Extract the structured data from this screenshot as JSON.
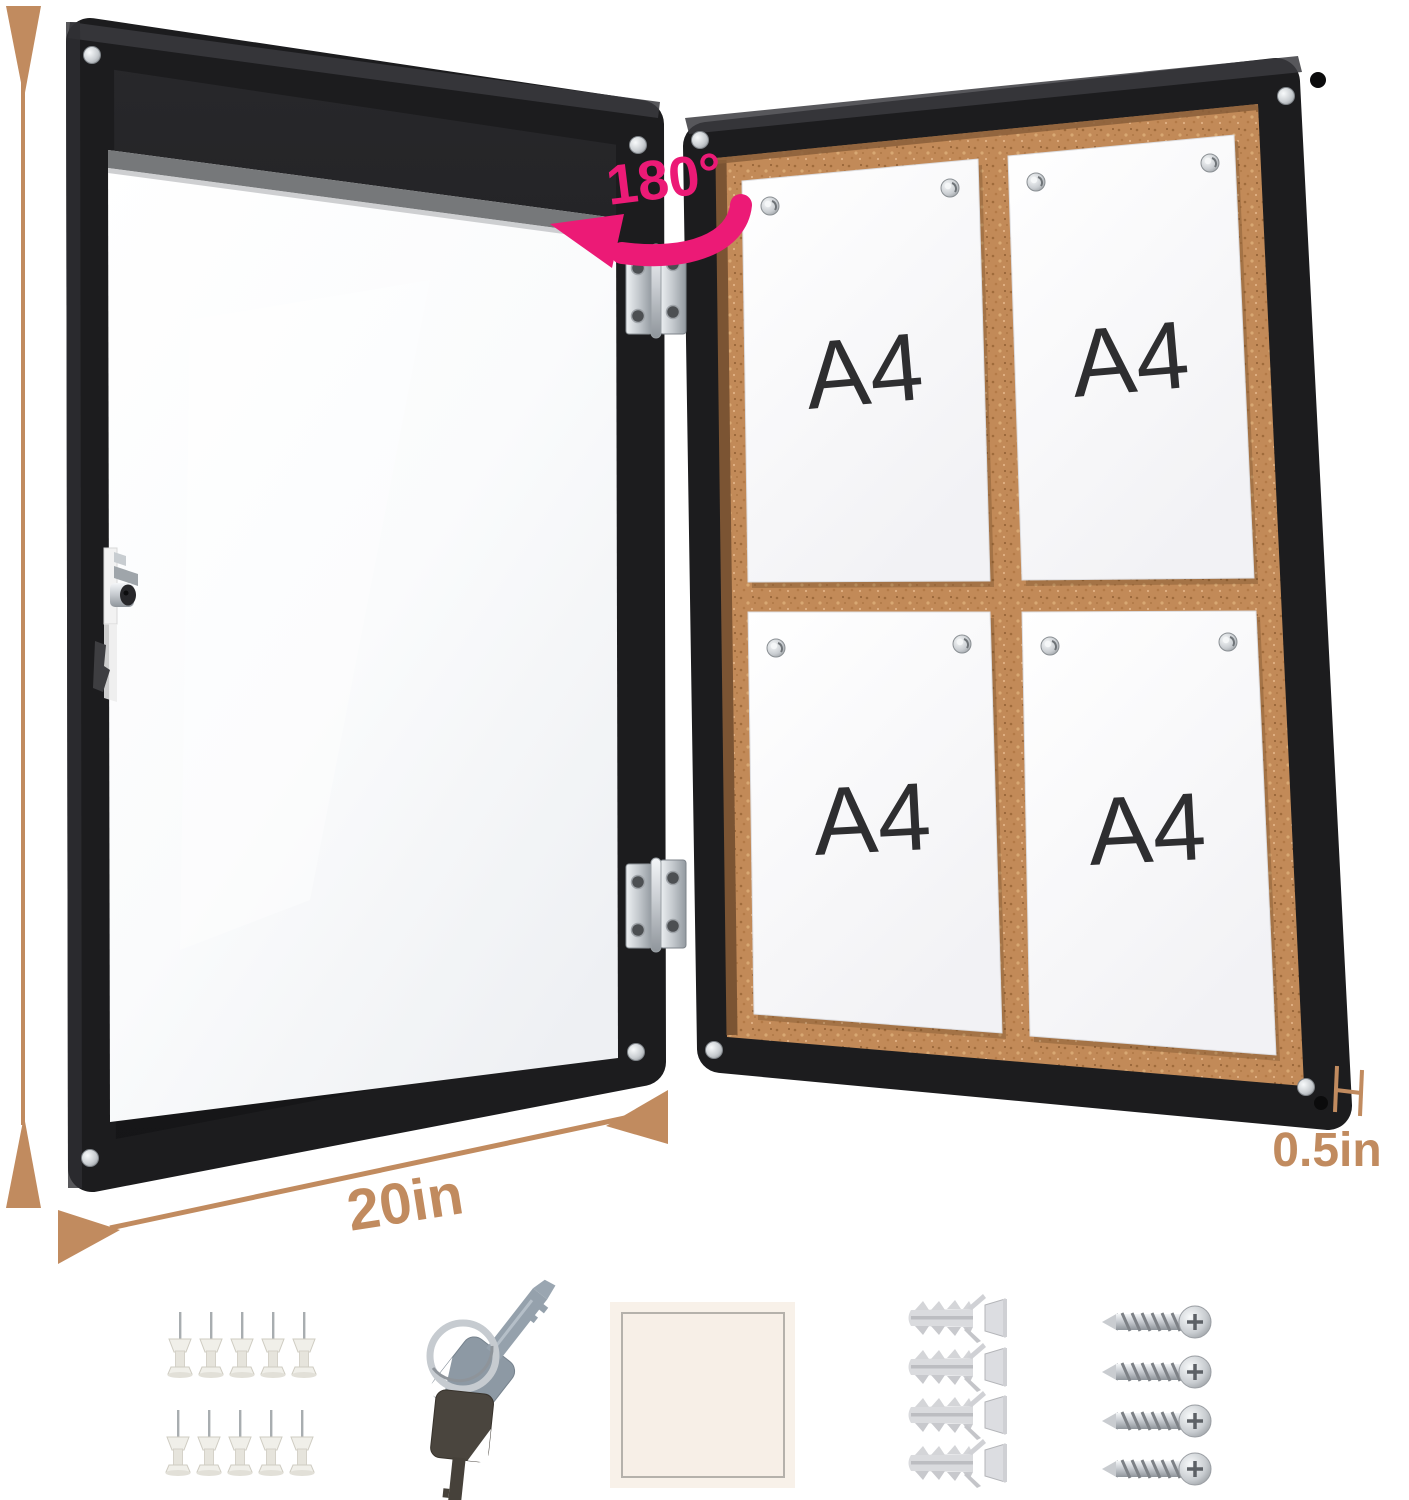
{
  "product": {
    "description": "Enclosed cork bulletin board with lockable glass door shown open",
    "capacity_sheets": 4
  },
  "dimensions": {
    "height": "26in",
    "width": "20in",
    "depth": "0.5in"
  },
  "rotation": {
    "label": "180°"
  },
  "papers": {
    "labels": [
      "A4",
      "A4",
      "A4",
      "A4"
    ]
  },
  "accessories": {
    "push_pins": {
      "name": "push-pins",
      "count": 10
    },
    "keys": {
      "name": "keys",
      "count": 2
    },
    "adhesive_pad": {
      "name": "adhesive-pad",
      "count": 1
    },
    "wall_anchors": {
      "name": "wall-anchors",
      "count": 4
    },
    "screws": {
      "name": "screws",
      "count": 4
    }
  },
  "colors": {
    "frame_black": "#1c1c1e",
    "cork_brown": "#c28a58",
    "dimension_tan": "#c18b5f",
    "rotation_pink": "#ec1a76",
    "paper_white": "#ffffff",
    "a4_text": "#2e2e30",
    "chrome_silver": "#d8dadc"
  }
}
